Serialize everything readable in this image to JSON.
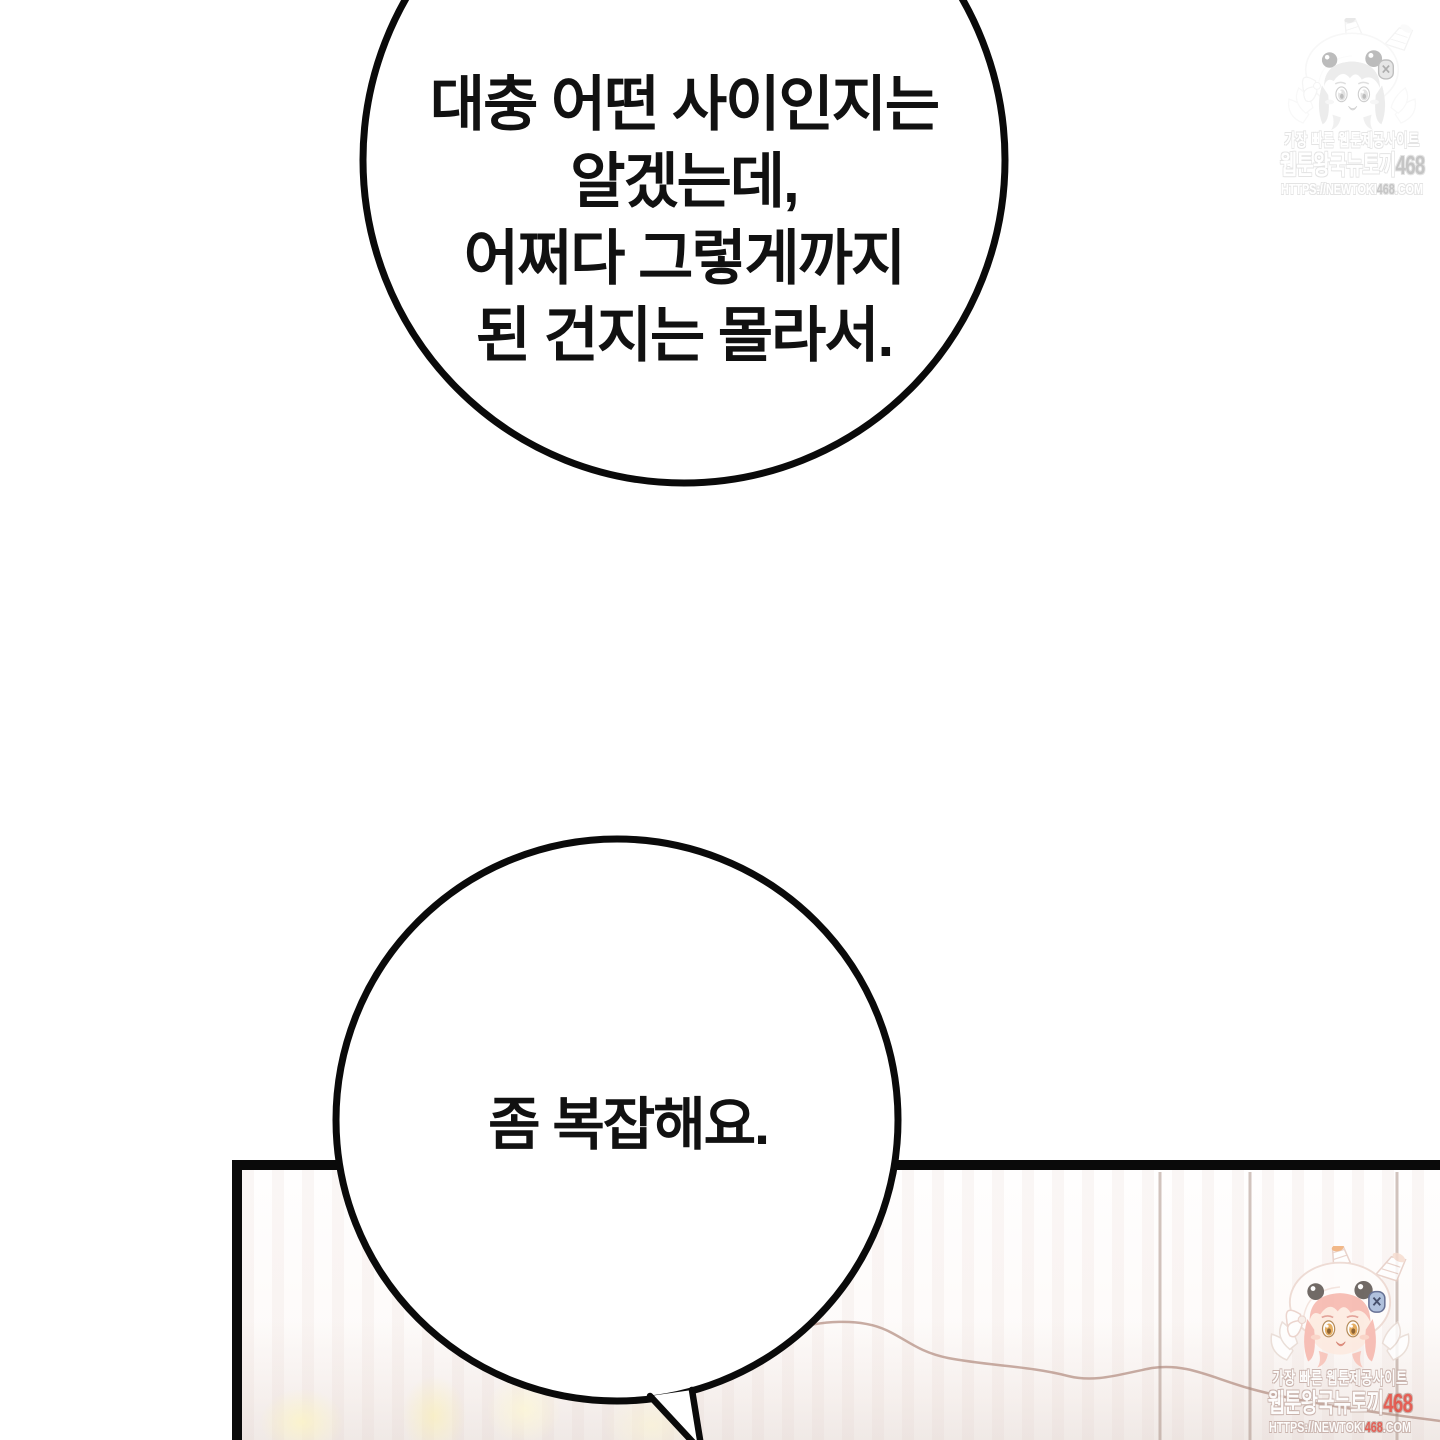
{
  "page": {
    "background_color": "#ffffff",
    "ink_color": "#0a0a0a"
  },
  "bubbles": [
    {
      "id": "bubble-top",
      "lines": [
        "대충 어떤 사이인지는",
        "알겠는데,",
        "어쩌다 그렇게까지",
        "된 건지는 몰라서."
      ]
    },
    {
      "id": "bubble-bottom",
      "lines": [
        "좀 복잡해요."
      ]
    }
  ],
  "panel": {
    "border_color": "#0a0a0a",
    "frame_line_color": "#a58a7e"
  },
  "watermark": {
    "character": "bunny-hood-girl-mascot",
    "tagline": "가장 빠른 웹툰제공사이트",
    "site_name_prefix": "웹툰왕국뉴토끼",
    "site_number": "468",
    "url_prefix": "HTTPS://NEWTOKI",
    "url_number": "468",
    "url_suffix": ".COM",
    "accent_color": "#e2473c"
  }
}
